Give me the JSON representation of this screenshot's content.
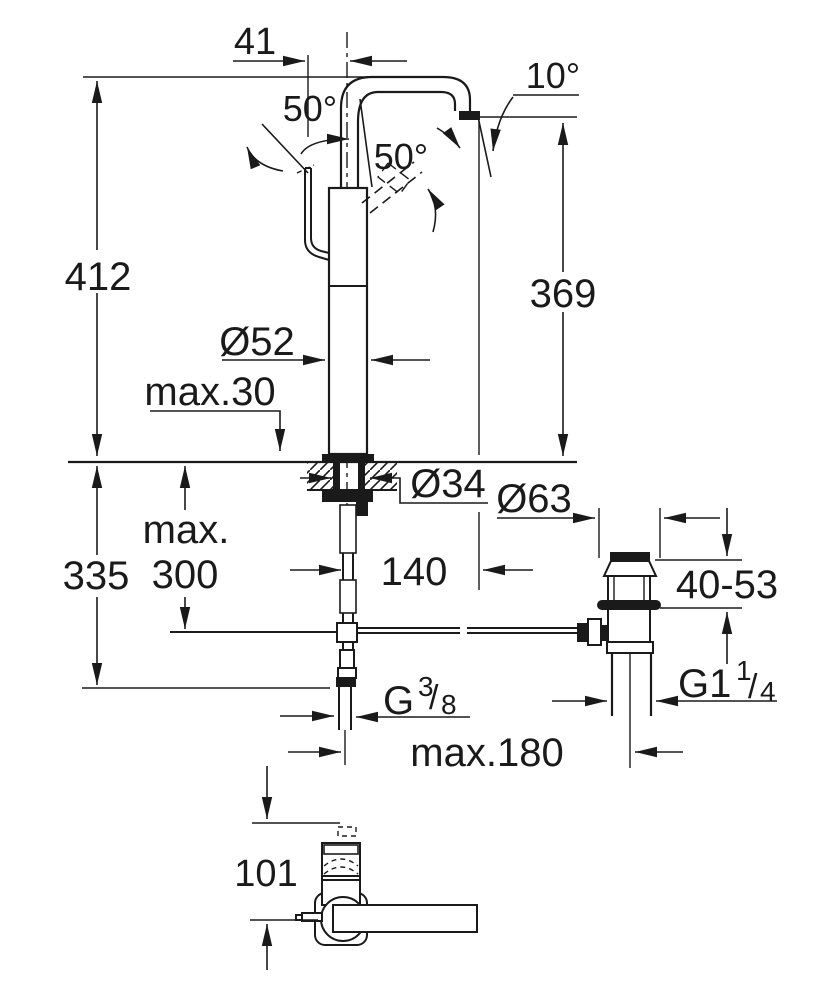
{
  "drawing": {
    "type": "faucet-installation-dimension-diagram",
    "colors": {
      "line": "#1a1a1a",
      "background": "#ffffff"
    },
    "labels": {
      "handle_offset": "41",
      "spout_angle": "10°",
      "swivel_left": "50°",
      "swivel_right": "50°",
      "total_height": "412",
      "spout_height": "369",
      "body_diameter": "Ø52",
      "base_max": "max.30",
      "shank_diameter": "Ø34",
      "drain_flange_diameter": "Ø63",
      "hose_max_word": "max.",
      "hose_max_value": "300",
      "hose_total": "335",
      "spout_reach": "140",
      "deck_thickness_range": "40-53",
      "supply_thread_g": "G",
      "supply_thread_num": "3",
      "supply_thread_slash": "/",
      "supply_thread_den": "8",
      "drain_thread_g": "G1",
      "drain_thread_num": "1",
      "drain_thread_slash": "/",
      "drain_thread_den": "4",
      "drain_distance": "max.180",
      "top_view_reach": "101"
    }
  }
}
